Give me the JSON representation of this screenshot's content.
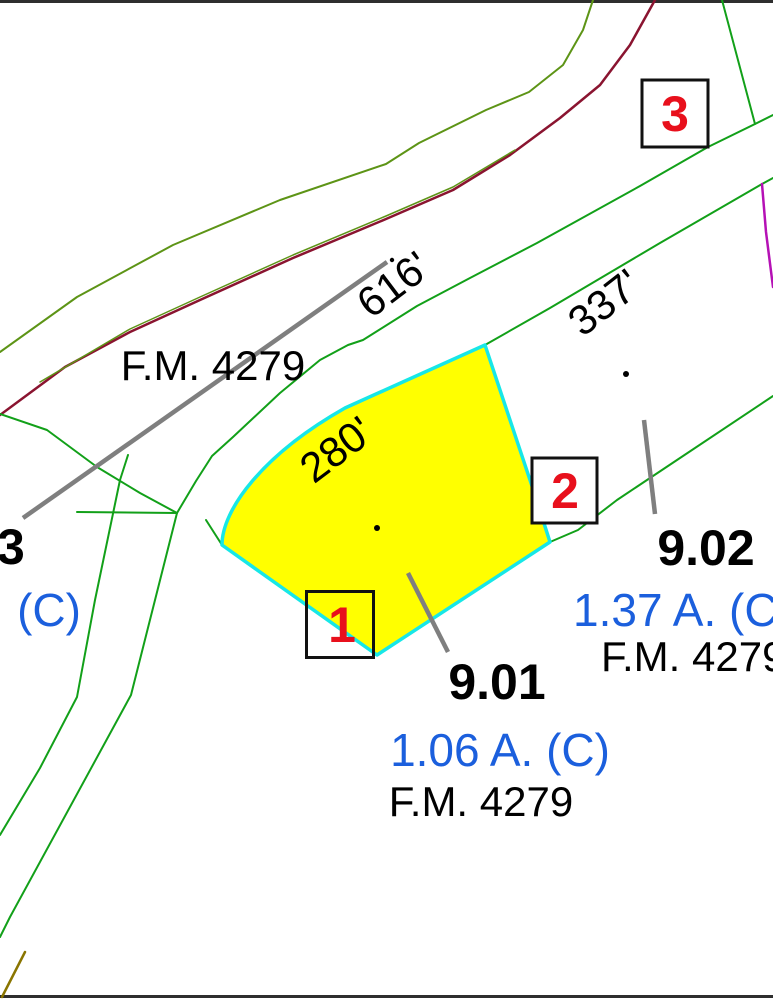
{
  "map_type": "parcel-cadastral-map",
  "road": {
    "label_left": "F.M. 4279"
  },
  "dimensions": {
    "d616": "616'",
    "d337": "337'",
    "d280": "280'"
  },
  "markers": {
    "m1": "1",
    "m2": "2",
    "m3": "3"
  },
  "parcels": {
    "p901": {
      "number": "9.01",
      "acreage": "1.06 A. (C)",
      "road": "F.M. 4279"
    },
    "p902": {
      "number": "9.02",
      "acreage": "1.37 A. (C)",
      "road": "F.M. 4279"
    },
    "p_edge_left": {
      "number_partial": "3",
      "acreage_partial": "(C)"
    }
  },
  "colors": {
    "parcel_fill": "#ffff00",
    "parcel_stroke": "#17e7e7",
    "road_line_green": "#12a019",
    "curve_line_green": "#5d9416",
    "road_centerline_maroon": "#8a1430",
    "boundary_purple": "#b511b5",
    "leader_gray": "#7f7f7f",
    "marker_red": "#e8101c",
    "acreage_blue": "#1b5fdd",
    "text_black": "#000000",
    "olive_line": "#8a7500",
    "background": "#ffffff"
  }
}
